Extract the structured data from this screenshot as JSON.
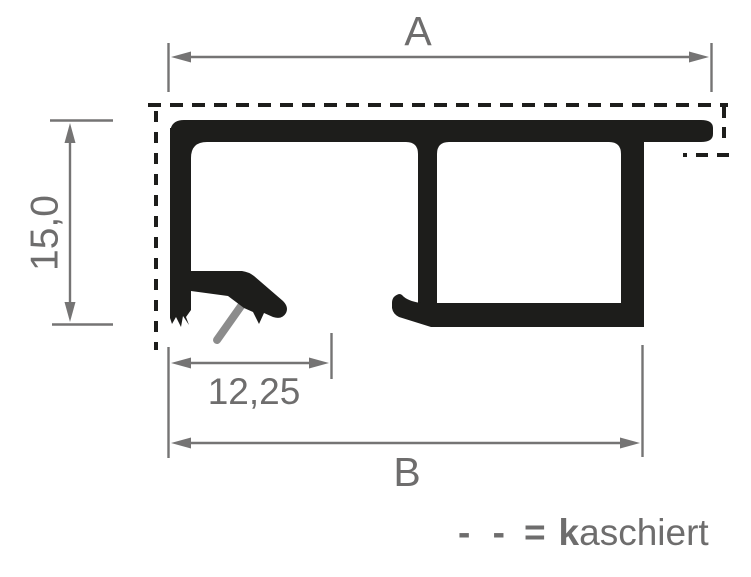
{
  "drawing": {
    "type": "profile-cross-section",
    "dimensions": {
      "top": "A",
      "left": "15,0",
      "clip": "12,25",
      "bottom": "B"
    },
    "legend": {
      "dashes": "- -",
      "equals": "=",
      "term_bold": "k",
      "term_rest": "aschiert"
    },
    "colors": {
      "profile_black": "#1d1d1b",
      "dimension_gray": "#757474",
      "text_gray": "#6e6d6d",
      "spring_gray": "#8c8c8c",
      "background": "#ffffff"
    }
  }
}
